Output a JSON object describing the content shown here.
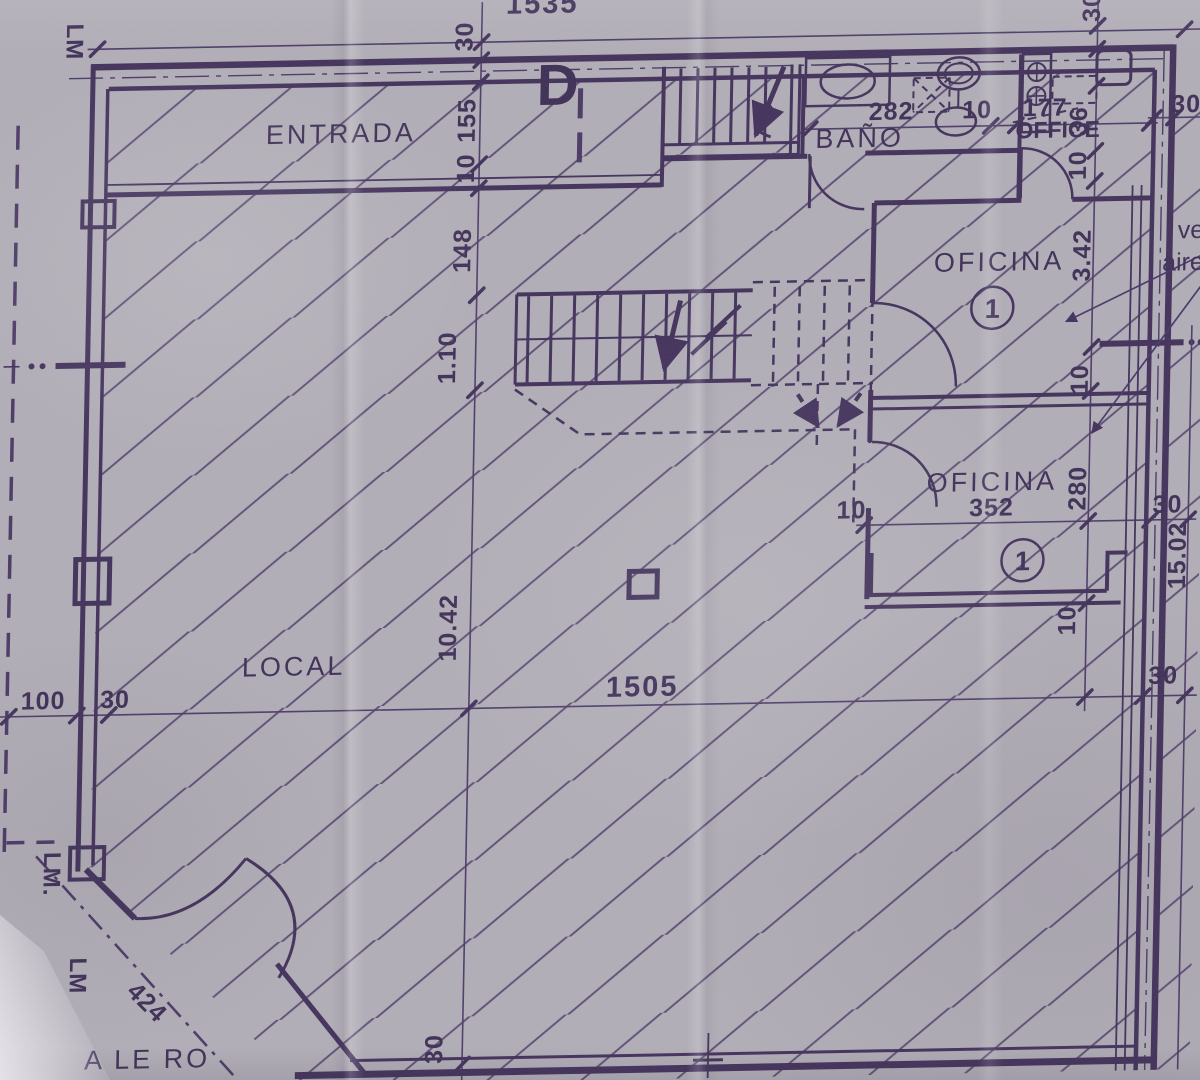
{
  "colors": {
    "paper": "#b2aeb7",
    "ink": "#3e2d57",
    "ink_thin": "#544170"
  },
  "rooms": {
    "entrada": "ENTRADA",
    "bano": "BAÑO",
    "office": "OFFICE",
    "oficina_upper": "OFICINA",
    "oficina_upper_number": "1",
    "oficina_lower": "OFICINA",
    "oficina_lower_number": "1",
    "local": "LOCAL",
    "alero": "A LE RO"
  },
  "markers": {
    "property_line_top": "LM",
    "property_line_corner": "LM.",
    "property_line_lower": "LM",
    "section_d": "D",
    "vent_note_line1": "ve",
    "vent_note_line2": "aire"
  },
  "dims": {
    "top_total": "1535",
    "wall_top": "30",
    "entrada_depth": "155",
    "inner_wall": "10",
    "hall_depth": "148",
    "stair_width": "1.10",
    "local_depth": "10.42",
    "wall_bottom": "30",
    "sidewalk": "100",
    "wall_left": "30",
    "local_width": "1505",
    "wall_right": "30",
    "bano_width": "282",
    "bano_wall": "10",
    "office_width": "177",
    "tr_wall": "30",
    "tr_36": "36",
    "tr_10": "10",
    "corner_30": "30",
    "oficina_upper_height": "3.42",
    "oficina_upper_wall": "10",
    "oficina_lower_height": "280",
    "oficina_lower_width": "352",
    "oficina_lower_wall_left": "10",
    "oficina_lower_wall_right": "30",
    "oficina_lower_wall_bottom": "10",
    "right_total": "15.02",
    "chamfer_length": "424"
  }
}
